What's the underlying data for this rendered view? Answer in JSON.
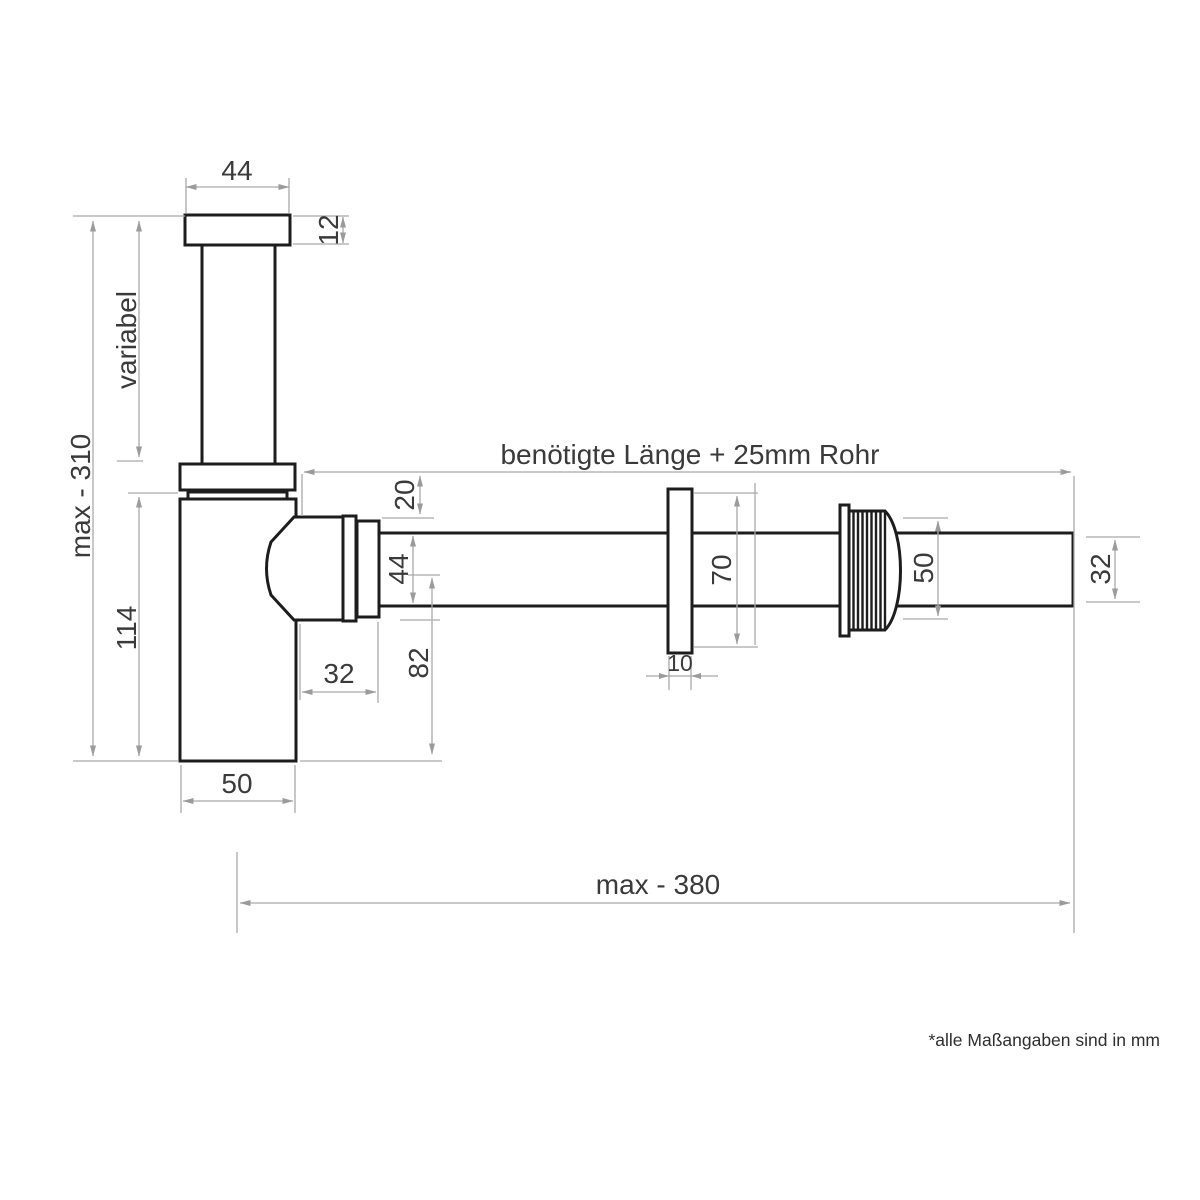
{
  "drawing": {
    "unit_note": "*alle Maßangaben sind in mm",
    "labels": {
      "flange_width": "44",
      "flange_thickness": "12",
      "riser": "variabel",
      "max_height": "max - 310",
      "body_height": "114",
      "inlet_offset": "20",
      "pipe_od": "44",
      "axis_to_bottom": "82",
      "elbow_projection": "32",
      "body_width": "50",
      "required_length": "benötigte Länge + 25mm Rohr",
      "plate_height": "70",
      "plate_thickness": "10",
      "nut_od": "50",
      "end_od": "32",
      "max_length": "max - 380"
    }
  }
}
